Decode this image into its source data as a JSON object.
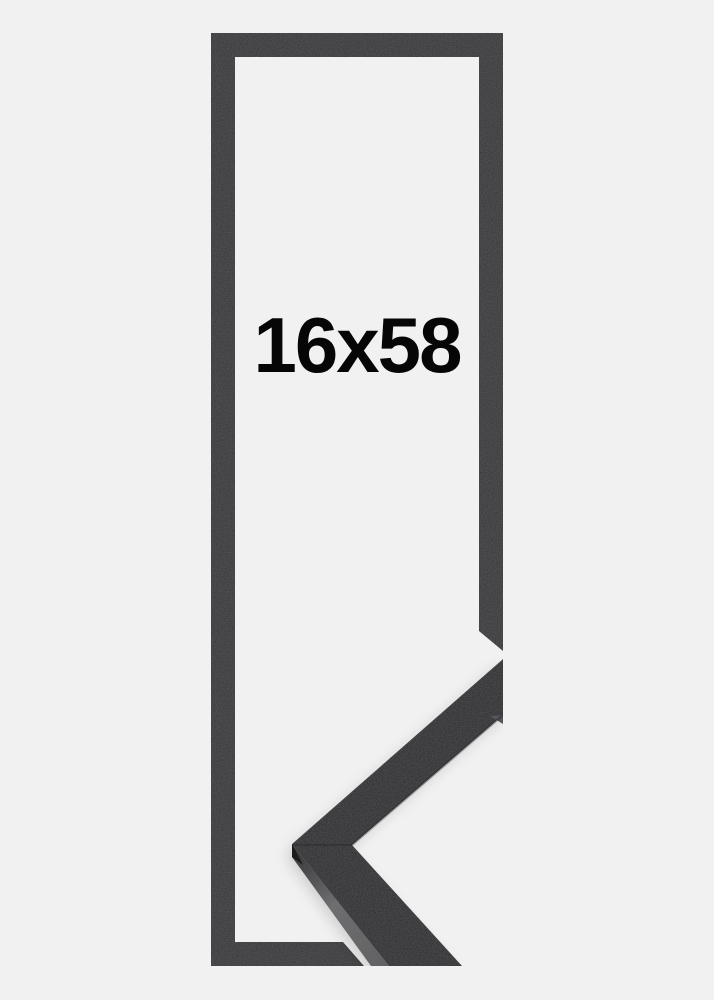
{
  "product": {
    "size_label": "16x58",
    "frame_color_name": "black"
  },
  "colors": {
    "background": "#f1f1f2",
    "frame_outline": "#353537",
    "corner_front_face": "#2c2c2e",
    "corner_side_face_dark": "#3a3a3c",
    "corner_side_face_light": "#6e6e70",
    "corner_edge_shadow": "#1c1c1e",
    "label_text": "#060606"
  },
  "icons": {
    "frame_outline_graphic": "picture-frame-outline",
    "corner_sample_photo": "frame-corner-moulding-profile"
  }
}
